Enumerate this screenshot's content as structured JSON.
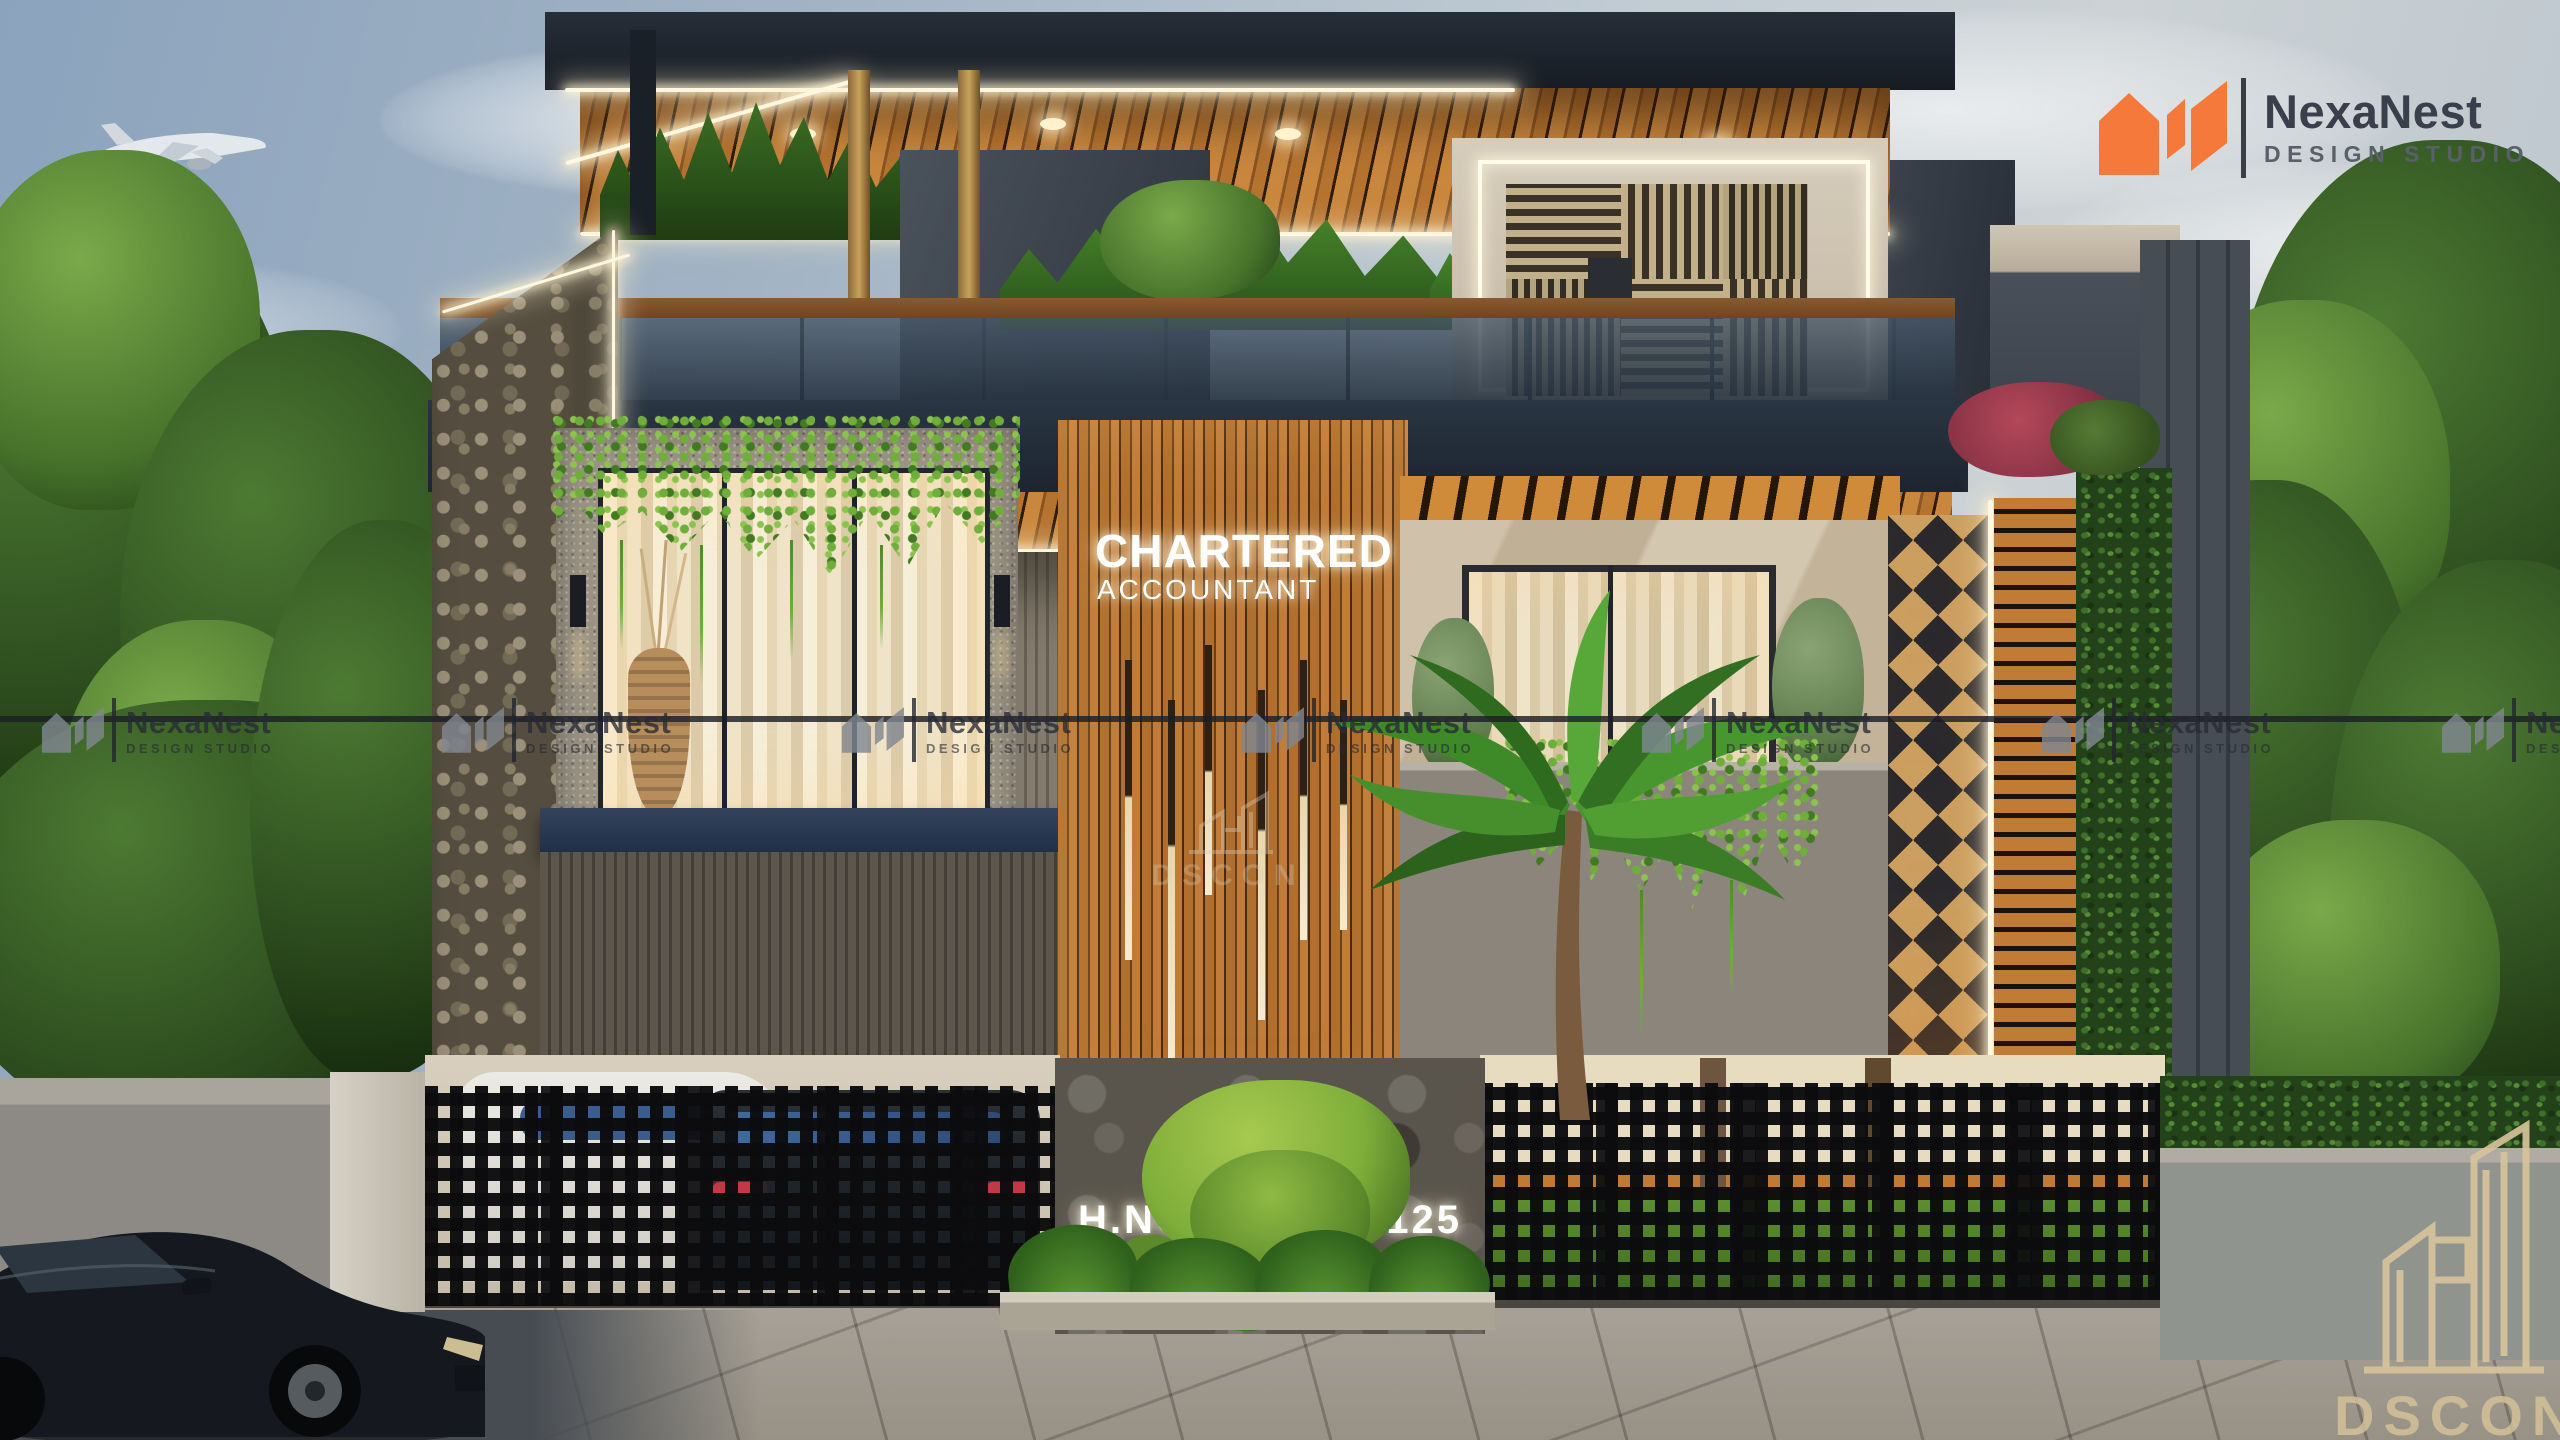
{
  "brand": {
    "name": "NexaNest",
    "tagline": "DESIGN STUDIO"
  },
  "signs": {
    "business_line1": "CHARTERED",
    "business_line2": "ACCOUNTANT",
    "address_left": "H.NO.",
    "address_right": "R- 125",
    "address_line2": "SUNNY ENCLAVE"
  },
  "watermark": {
    "name": "NexaNest",
    "tagline": "DESIGN STUDIO",
    "studio_logo": "DSCON"
  },
  "colors": {
    "brand_orange": "#f4793b",
    "wood": "#b9762f",
    "fascia_navy": "#232d3a",
    "led_white": "#fff6e2",
    "dscon_beige": "#d9c49c",
    "sign_glow": "#ffffff"
  }
}
